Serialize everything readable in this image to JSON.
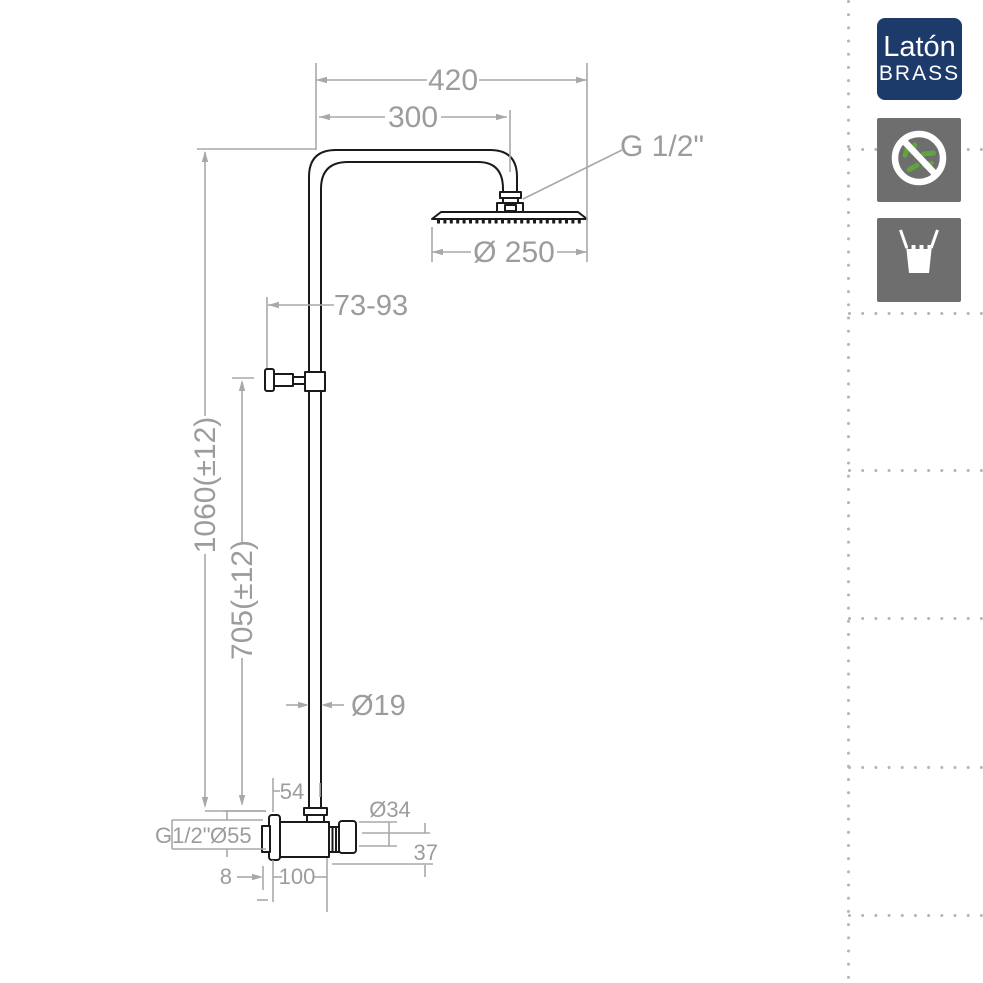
{
  "drawing": {
    "line_color": "#1a1a1a",
    "dimension_color": "#9c9c9c",
    "dims": {
      "top_width": "420",
      "arm_reach": "300",
      "head_thread": "G 1/2\"",
      "head_diameter": "Ø 250",
      "bracket_range": "73-93",
      "total_height": "1060(±12)",
      "riser_height": "705(±12)",
      "pipe_diameter": "Ø19",
      "valve_offset": "54",
      "handle_diameter": "Ø34",
      "handle_depth": "37",
      "inlet_thread": "G1/2\"",
      "flange_diameter": "Ø55",
      "nipple_depth": "8",
      "valve_length": "100"
    }
  },
  "side_panel": {
    "material_badge": {
      "top": "Latón",
      "bottom": "BRASS",
      "background": "#1c3a6a",
      "text_color": "#ffffff"
    },
    "icons": [
      {
        "name": "no-bacteria-icon",
        "background": "#6e6e6e",
        "rod_color": "#5fa43c"
      },
      {
        "name": "water-glass-icon",
        "background": "#6e6e6e"
      }
    ]
  }
}
